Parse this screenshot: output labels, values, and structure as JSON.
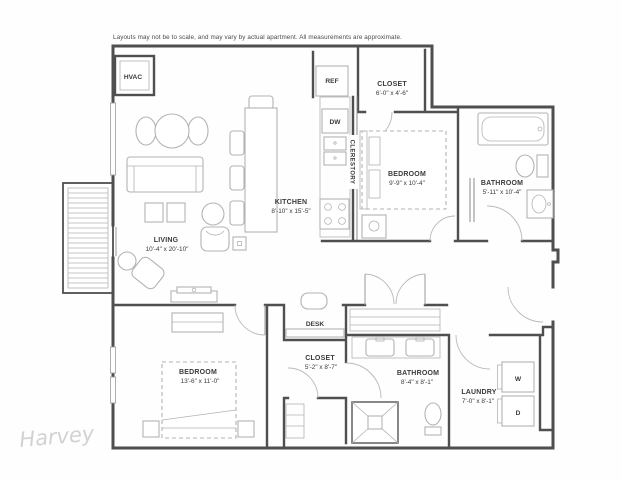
{
  "meta": {
    "disclaimer": "Layouts may not be to scale, and may vary by actual apartment. All measurements are approximate.",
    "watermark": "Harvey"
  },
  "colors": {
    "background": "#fefefe",
    "wall": "#4f4f4f",
    "fixture": "#b3b3b3",
    "label": "#3a3a3a",
    "watermark": "#d2d2d2"
  },
  "rooms": {
    "living": {
      "label": "LIVING",
      "dims": "10'-4\" x 20'-10\""
    },
    "kitchen": {
      "label": "KITCHEN",
      "dims": "8'-10\" x 15'-5\""
    },
    "bedroom_top": {
      "label": "BEDROOM",
      "dims": "9'-9\" x 10'-4\""
    },
    "bathroom_top": {
      "label": "BATHROOM",
      "dims": "5'-11\" x 10'-4\""
    },
    "closet_top": {
      "label": "CLOSET",
      "dims": "6'-0\" x 4'-6\""
    },
    "bedroom_bottom": {
      "label": "BEDROOM",
      "dims": "13'-6\" x 11'-0\""
    },
    "closet_bottom": {
      "label": "CLOSET",
      "dims": "5'-2\" x 8'-7\""
    },
    "bathroom_bottom": {
      "label": "BATHROOM",
      "dims": "8'-4\" x 8'-1\""
    },
    "laundry": {
      "label": "LAUNDRY",
      "dims": "7'-0\" x 8'-1\""
    }
  },
  "fixtures": {
    "hvac": "HVAC",
    "ref": "REF",
    "dw": "DW",
    "clerestory": "CLERESTORY",
    "desk": "DESK",
    "washer": "W",
    "dryer": "D"
  }
}
